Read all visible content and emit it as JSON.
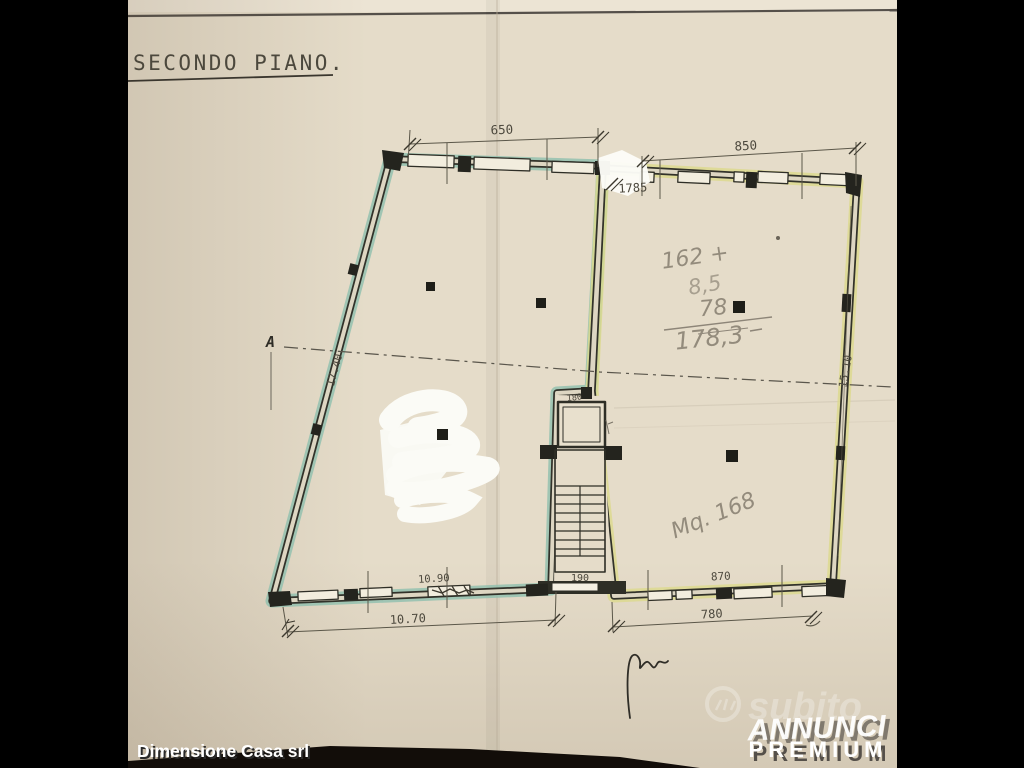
{
  "photo": {
    "plan_title": "SECONDO PIANO.",
    "agency_watermark": "Dimensione Casa srl",
    "brand_watermark": {
      "logo": "subito-hand-logo",
      "name": "subito",
      "line1": "ANNUNCI",
      "line2": "PREMIUM"
    }
  },
  "floor_plan": {
    "dimensions": {
      "top_left_wall": "650",
      "top_right_wall": "850",
      "top_inner": "1785",
      "left_wall": "17.40",
      "right_wall": "15.10",
      "bottom_inner_left": "10.90",
      "stair_width": "190",
      "bottom_inner_right": "870",
      "bottom_outer_left": "10.70",
      "bottom_outer_right": "780",
      "elevator_width": "180"
    },
    "markers": {
      "section": "A"
    },
    "pencil_sum": {
      "addend1": "162 +",
      "addend2": "8,5",
      "addend3": "78",
      "total": "178,3",
      "area_note": "Mq. 168"
    },
    "colors": {
      "paper": "#e5dcc9",
      "left_unit_highlight": "#8fbfae",
      "right_unit_highlight": "#dcd98c",
      "ink": "#32322a",
      "pencil": "#97907f"
    }
  }
}
